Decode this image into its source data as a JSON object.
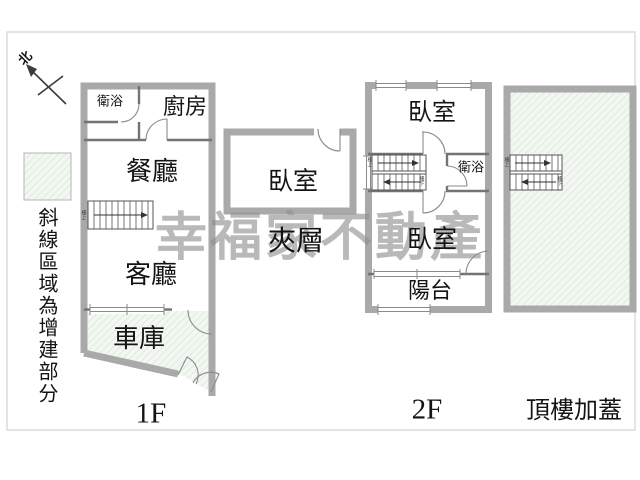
{
  "plan": {
    "compass_label": "北",
    "legend": {
      "note": "斜線區域為增建部分"
    },
    "watermark": "幸福家不動產",
    "floor_1f": {
      "label": "1F",
      "rooms": {
        "bath": "衛浴",
        "kitchen": "廚房",
        "dining": "餐廳",
        "living": "客廳",
        "garage": "車庫"
      },
      "stair_note_up": "樓上"
    },
    "mezzanine": {
      "label": "夾層",
      "rooms": {
        "bedroom": "臥室"
      }
    },
    "floor_2f": {
      "label": "2F",
      "rooms": {
        "bedroom_front": "臥室",
        "bath": "衛浴",
        "bedroom_rear": "臥室",
        "balcony": "陽台"
      },
      "stair_note_up": "樓上",
      "stair_note_down": "樓下"
    },
    "rooftop": {
      "label": "頂樓加蓋",
      "stair_note_up": "樓上",
      "stair_note_down": "樓下"
    }
  },
  "colors": {
    "wall": "#a9a9a9",
    "partition": "#737373",
    "door_arc": "#8a8a8a",
    "addition_fill": "#f2f7f1",
    "addition_hatch": "#d3e3d1",
    "watermark": "#8f8f8f",
    "frame": "#dcdcdc",
    "label_text": "#141414"
  }
}
